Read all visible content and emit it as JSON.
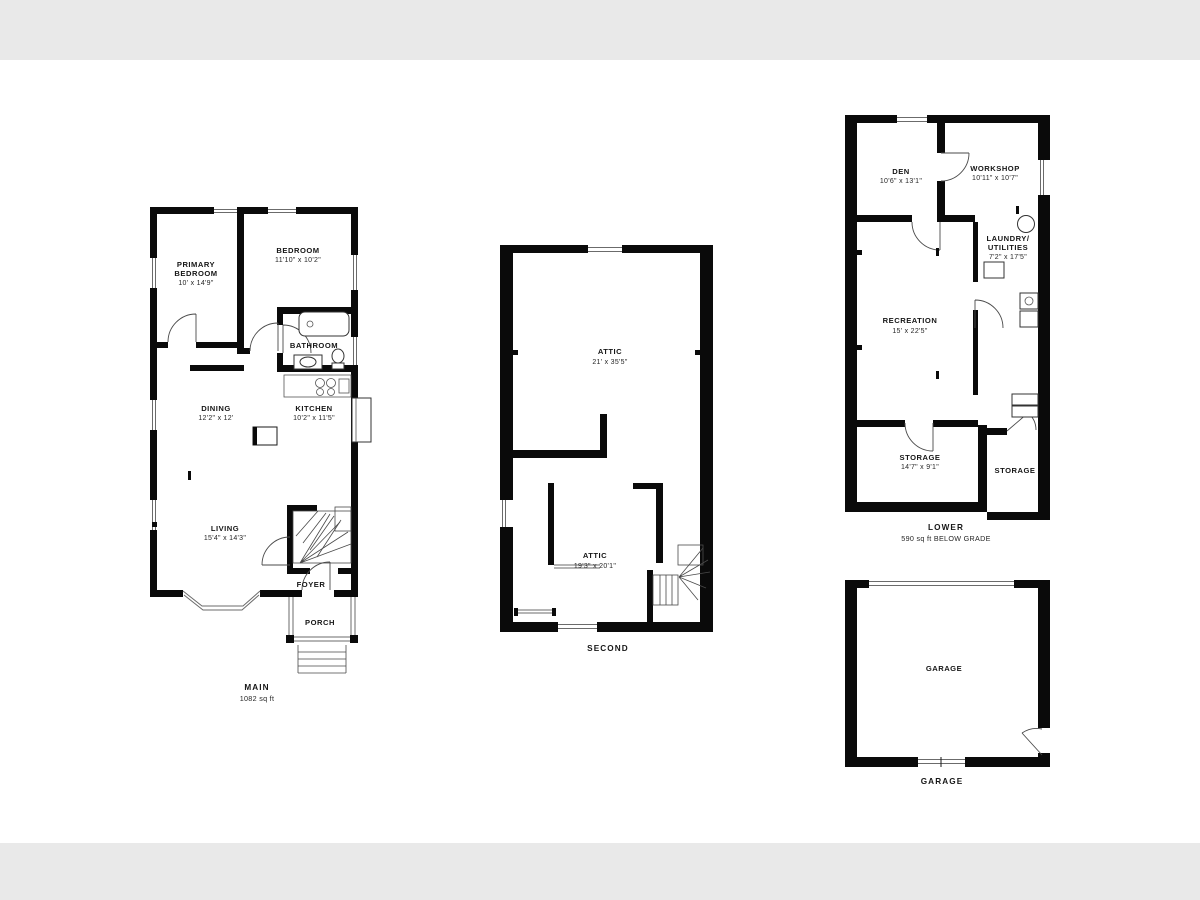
{
  "canvas": {
    "background": "#ffffff",
    "letterbox_color": "#e9e9e9",
    "ink": "#0a0a0a"
  },
  "plans": {
    "main": {
      "caption": "MAIN",
      "area": "1082 sq ft",
      "rooms": {
        "primary_bedroom": {
          "name1": "PRIMARY",
          "name2": "BEDROOM",
          "dims": "10' x 14'9\""
        },
        "bedroom": {
          "name1": "BEDROOM",
          "dims": "11'10\" x 10'2\""
        },
        "bathroom": {
          "name1": "BATHROOM"
        },
        "dining": {
          "name1": "DINING",
          "dims": "12'2\" x 12'"
        },
        "kitchen": {
          "name1": "KITCHEN",
          "dims": "10'2\" x 11'5\""
        },
        "living": {
          "name1": "LIVING",
          "dims": "15'4\" x 14'3\""
        },
        "foyer": {
          "name1": "FOYER"
        },
        "porch": {
          "name1": "PORCH"
        }
      }
    },
    "second": {
      "caption": "SECOND",
      "rooms": {
        "attic_upper": {
          "name1": "ATTIC",
          "dims": "21' x 35'5\""
        },
        "attic_lower": {
          "name1": "ATTIC",
          "dims": "19'3\" x 20'1\""
        }
      }
    },
    "lower": {
      "caption": "LOWER",
      "area": "590 sq ft BELOW GRADE",
      "rooms": {
        "den": {
          "name1": "DEN",
          "dims": "10'6\" x 13'1\""
        },
        "workshop": {
          "name1": "WORKSHOP",
          "dims": "10'11\" x 10'7\""
        },
        "laundry": {
          "name1": "LAUNDRY/",
          "name2": "UTILITIES",
          "dims": "7'2\" x 17'5\""
        },
        "recreation": {
          "name1": "RECREATION",
          "dims": "15' x 22'5\""
        },
        "storage": {
          "name1": "STORAGE",
          "dims": "14'7\" x 9'1\""
        },
        "storage2": {
          "name1": "STORAGE"
        }
      }
    },
    "garage": {
      "caption": "GARAGE",
      "rooms": {
        "garage": {
          "name1": "GARAGE"
        }
      }
    }
  }
}
